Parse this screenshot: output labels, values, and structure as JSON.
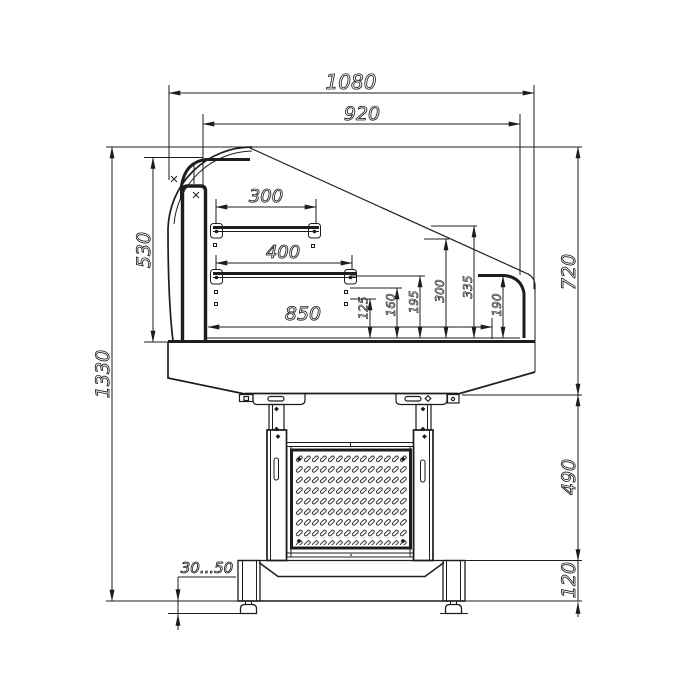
{
  "drawing": {
    "type": "technical-dimension-drawing",
    "subject": "refrigerated display counter side cross-section",
    "units": "mm",
    "dims": {
      "overall_width": "1080",
      "case_top_width": "920",
      "upper_shelf_width": "300",
      "lower_shelf_width": "400",
      "deck_interior_width": "850",
      "front_glass_height": "530",
      "overall_height": "1330",
      "case_body_height": "720",
      "stand_height": "490",
      "base_frame_height": "120",
      "deck_level_1": "125",
      "deck_level_2": "160",
      "deck_level_3": "195",
      "deck_level_4": "300",
      "deck_level_5": "335",
      "rear_rail_height": "190",
      "foot_adjust_range": "30...50"
    }
  }
}
